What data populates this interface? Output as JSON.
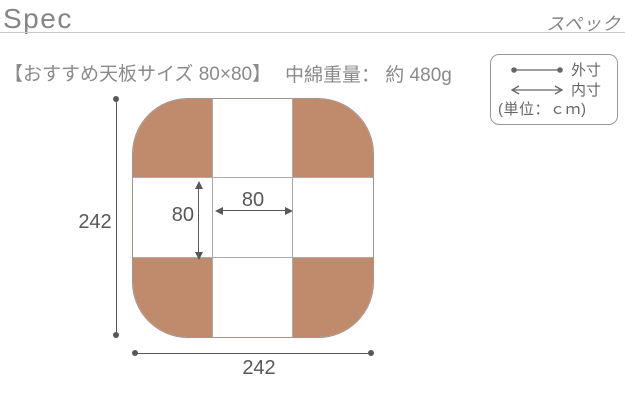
{
  "header": {
    "title_en": "Spec",
    "title_ja": "スペック"
  },
  "subheader": {
    "recommended_size": "【おすすめ天板サイズ 80×80】",
    "filling_weight": "中綿重量： 約 480g"
  },
  "legend": {
    "outer_label": "外寸",
    "inner_label": "内寸",
    "unit_note": "(単位：ｃｍ)"
  },
  "diagram": {
    "outer_width": "242",
    "outer_height": "242",
    "inner_width": "80",
    "inner_height": "80"
  },
  "colors": {
    "brown": "#c08a6c",
    "board-outline": "#a3948c",
    "grid-line": "#ababab",
    "dim": "#595757",
    "text-gray": "#8a8a8a",
    "title-gray": "#858585",
    "legend-border": "#999999",
    "legend-text": "#666666",
    "rule": "#c9c9c9"
  }
}
